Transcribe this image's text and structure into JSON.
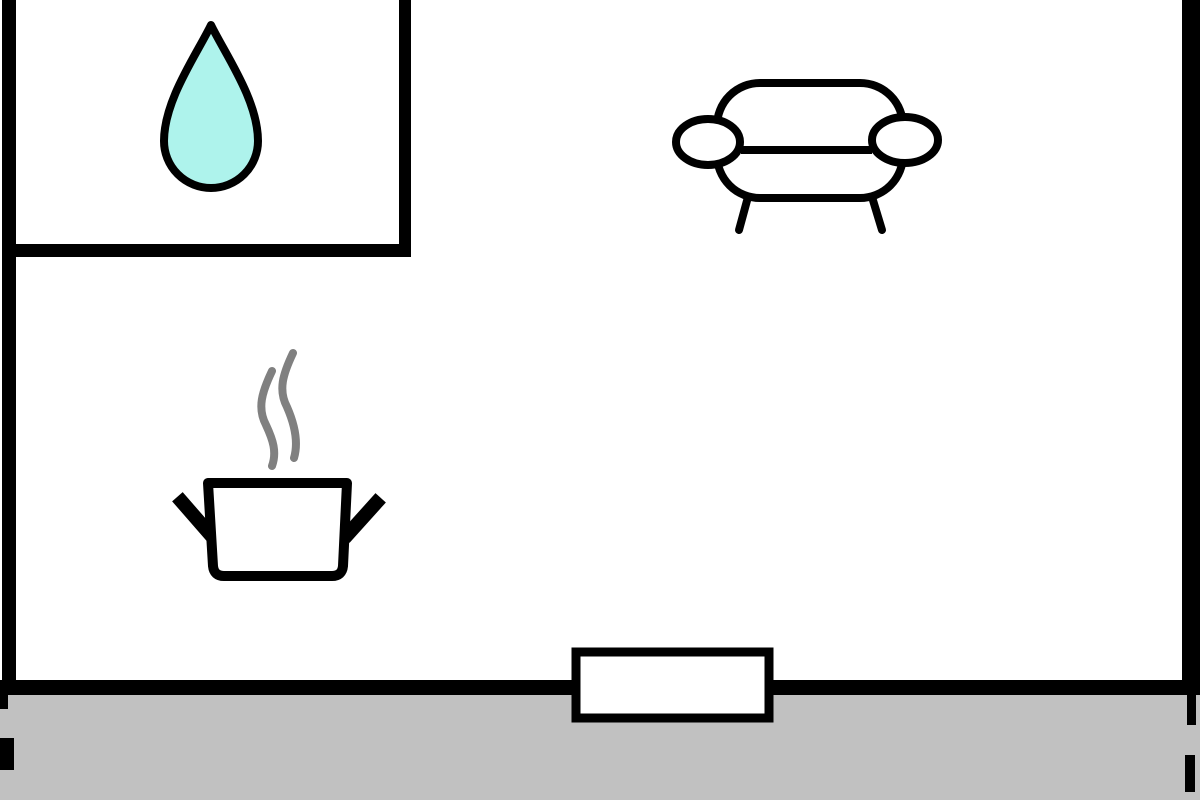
{
  "scene": {
    "kind": "floor-plan-drawing"
  },
  "colors": {
    "background": "#ffffff",
    "wall": "#000000",
    "outline": "#000000",
    "outside_ground": "#c1c1c1",
    "water_drop_fill": "#aef3ec",
    "water_drop_stroke": "#000000",
    "steam": "#808080",
    "white_fill": "#ffffff"
  },
  "icons": {
    "water_drop": "water-drop-icon",
    "cooking_pot": "cooking-pot-icon",
    "sofa": "sofa-icon",
    "door": "door-opening"
  }
}
